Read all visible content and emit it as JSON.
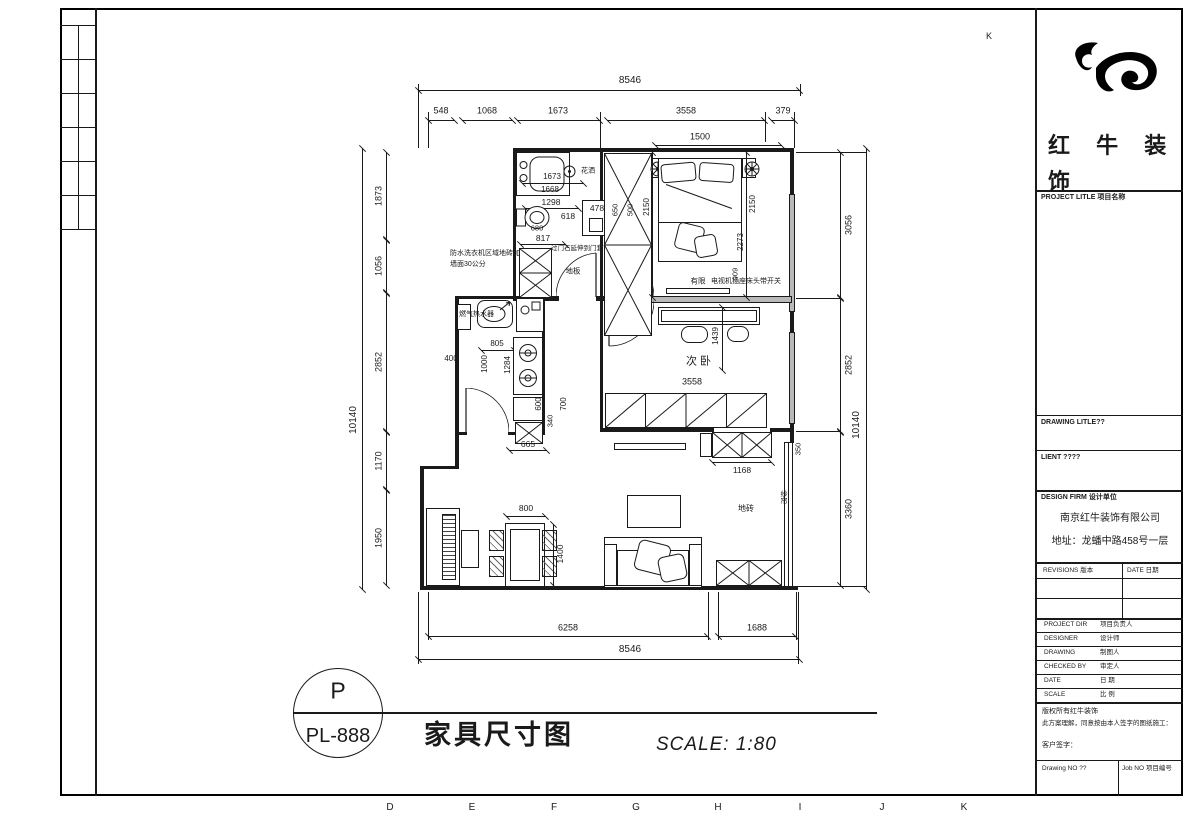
{
  "frame": {
    "top_letter": "K",
    "bottom_letters": [
      "D",
      "E",
      "F",
      "G",
      "H",
      "I",
      "J",
      "K"
    ]
  },
  "title_bar": {
    "circle_top": "P",
    "circle_bottom": "PL-888",
    "title": "家具尺寸图",
    "scale": "SCALE: 1:80"
  },
  "title_block": {
    "logo_text": "红 牛 装 饰",
    "project_title_label": "PROJECT LITLE 项目名称",
    "drawing_title_label": "DRAWING LITLE??",
    "client_label": "LIENT ????",
    "design_firm_label": "DESIGN FIRM 设计单位",
    "company": "南京红牛装饰有限公司",
    "address": "地址：龙蟠中路458号一层",
    "revisions_label": "REVISIONS 版本",
    "revisions_date_label": "DATE 日期",
    "rows": [
      {
        "en": "PROJECT DIR",
        "cn": "项目负责人"
      },
      {
        "en": "DESIGNER",
        "cn": "设计师"
      },
      {
        "en": "DRAWING",
        "cn": "制图人"
      },
      {
        "en": "CHECKED BY",
        "cn": "审定人"
      },
      {
        "en": "DATE",
        "cn": "日 期"
      },
      {
        "en": "SCALE",
        "cn": "比 例"
      }
    ],
    "copyright1": "版权所有红牛装饰",
    "copyright2": "此方案理解，同意按由本人签字的图纸施工：",
    "client_sign": "客户签字：",
    "drawing_no": "Drawing NO ??",
    "job_no": "Job NO 项目编号"
  },
  "plan": {
    "rooms": {
      "second_bedroom": "次卧"
    },
    "labels": {
      "shower": "花洒",
      "threshold": "过门石延伸到门套下",
      "laundry1": "防水洗衣机区域地砖加",
      "laundry2": "墙面30公分",
      "wood_floor": "地板",
      "water_heater": "燃气热水器",
      "tile_floor": "地砖",
      "curtain": "纱帘",
      "bed_note": "有限",
      "tv_note": "电视机插座床头带开关"
    },
    "dims": {
      "top_overall": "8546",
      "top": [
        "548",
        "1068",
        "1673",
        "3558",
        "379"
      ],
      "bed_width": "1500",
      "left_overall": "10140",
      "left": [
        "1873",
        "1056",
        "2852",
        "1170",
        "1950"
      ],
      "right_overall": "10140",
      "right": [
        "3056",
        "2852",
        "3360"
      ],
      "bottom_overall": "8546",
      "bottom": [
        "6258",
        "1688"
      ],
      "bath": [
        "1673",
        "1668",
        "1298",
        "618",
        "478",
        "680",
        "817"
      ],
      "kitchen": [
        "805",
        "600",
        "400",
        "1000",
        "1284",
        "600",
        "700",
        "340",
        "665"
      ],
      "bedroom": [
        "2150",
        "2150",
        "2273",
        "909",
        "650",
        "500"
      ],
      "bedroom2": [
        "1439",
        "3558",
        "1168",
        "350"
      ],
      "dining": [
        "800",
        "1400"
      ]
    }
  }
}
